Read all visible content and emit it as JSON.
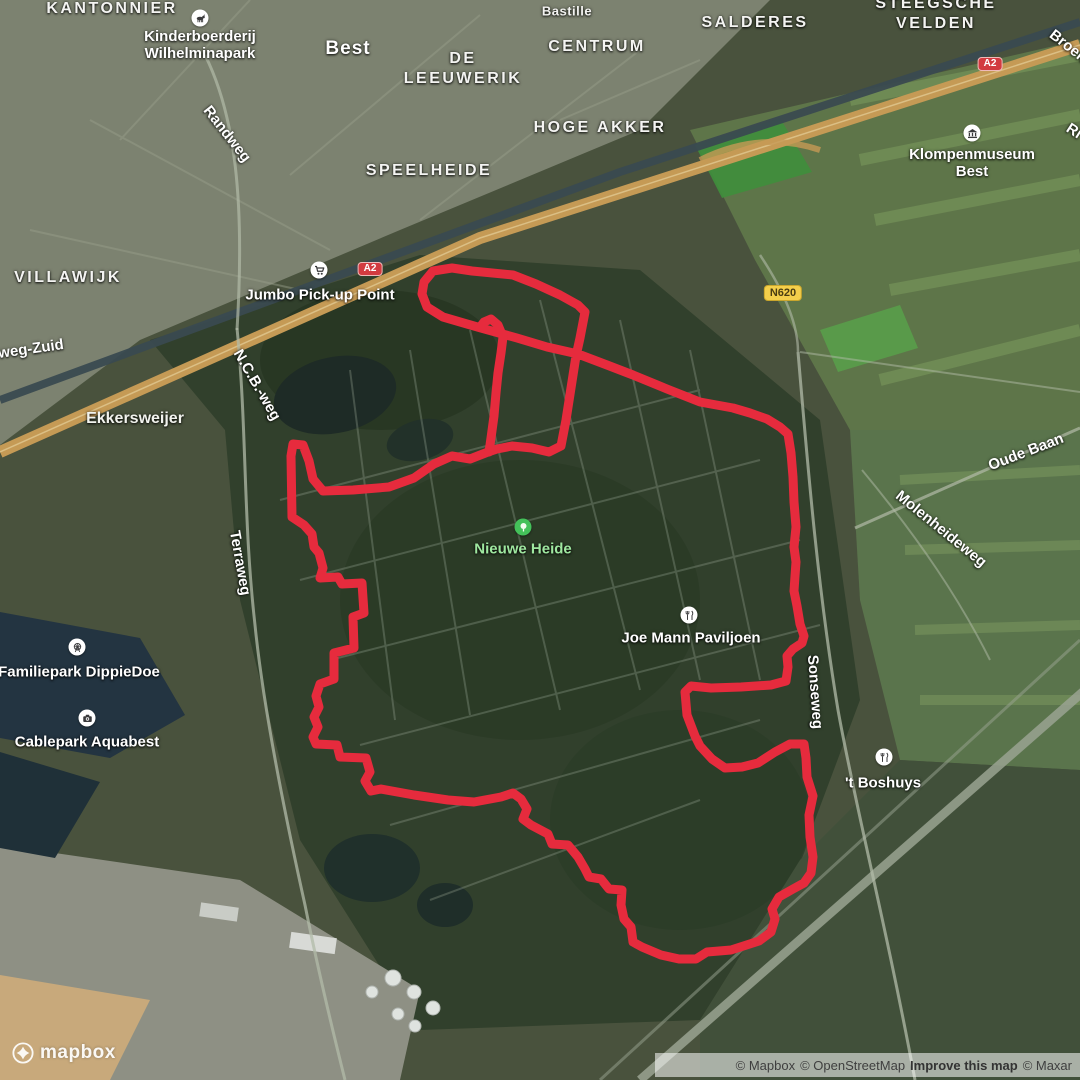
{
  "map": {
    "colors": {
      "route": "#e62b3d",
      "park_text": "#9fe8a0",
      "park_marker": "#44c15a"
    },
    "route": {
      "width": 9,
      "main": [
        [
          481,
          328
        ],
        [
          467,
          324
        ],
        [
          443,
          317
        ],
        [
          427,
          307
        ],
        [
          422,
          294
        ],
        [
          424,
          282
        ],
        [
          433,
          271
        ],
        [
          452,
          268
        ],
        [
          472,
          271
        ],
        [
          513,
          275
        ],
        [
          536,
          284
        ],
        [
          560,
          295
        ],
        [
          578,
          305
        ],
        [
          585,
          312
        ],
        [
          580,
          338
        ],
        [
          576,
          356
        ],
        [
          571,
          388
        ],
        [
          566,
          420
        ],
        [
          561,
          446
        ],
        [
          549,
          452
        ],
        [
          532,
          448
        ],
        [
          512,
          446
        ],
        [
          497,
          449
        ],
        [
          488,
          452
        ],
        [
          470,
          459
        ],
        [
          452,
          456
        ],
        [
          434,
          464
        ],
        [
          414,
          478
        ],
        [
          389,
          487
        ],
        [
          353,
          490
        ],
        [
          323,
          491
        ],
        [
          313,
          479
        ],
        [
          309,
          461
        ],
        [
          303,
          445
        ],
        [
          293,
          444
        ],
        [
          291,
          456
        ],
        [
          292,
          517
        ],
        [
          304,
          525
        ],
        [
          312,
          534
        ],
        [
          314,
          547
        ],
        [
          319,
          553
        ],
        [
          323,
          568
        ],
        [
          320,
          578
        ],
        [
          338,
          577
        ],
        [
          342,
          584
        ],
        [
          362,
          583
        ],
        [
          364,
          613
        ],
        [
          353,
          617
        ],
        [
          354,
          648
        ],
        [
          334,
          653
        ],
        [
          334,
          679
        ],
        [
          320,
          684
        ],
        [
          316,
          696
        ],
        [
          319,
          707
        ],
        [
          314,
          717
        ],
        [
          318,
          727
        ],
        [
          313,
          737
        ],
        [
          316,
          744
        ],
        [
          337,
          745
        ],
        [
          340,
          757
        ],
        [
          366,
          758
        ],
        [
          370,
          772
        ],
        [
          365,
          781
        ],
        [
          371,
          791
        ],
        [
          381,
          789
        ],
        [
          414,
          795
        ],
        [
          448,
          800
        ],
        [
          474,
          802
        ],
        [
          501,
          797
        ],
        [
          513,
          793
        ],
        [
          521,
          799
        ],
        [
          527,
          809
        ],
        [
          523,
          819
        ],
        [
          531,
          825
        ],
        [
          548,
          834
        ],
        [
          552,
          844
        ],
        [
          568,
          845
        ],
        [
          578,
          857
        ],
        [
          585,
          869
        ],
        [
          589,
          877
        ],
        [
          601,
          879
        ],
        [
          609,
          889
        ],
        [
          622,
          890
        ],
        [
          621,
          905
        ],
        [
          624,
          919
        ],
        [
          631,
          927
        ],
        [
          633,
          942
        ],
        [
          642,
          947
        ],
        [
          661,
          955
        ],
        [
          679,
          959
        ],
        [
          696,
          959
        ],
        [
          707,
          952
        ],
        [
          731,
          950
        ],
        [
          759,
          941
        ],
        [
          771,
          932
        ],
        [
          775,
          919
        ],
        [
          772,
          909
        ],
        [
          779,
          897
        ],
        [
          793,
          889
        ],
        [
          804,
          883
        ],
        [
          811,
          873
        ],
        [
          813,
          857
        ],
        [
          810,
          837
        ],
        [
          809,
          815
        ],
        [
          813,
          796
        ],
        [
          807,
          777
        ],
        [
          806,
          758
        ],
        [
          804,
          744
        ],
        [
          790,
          744
        ],
        [
          775,
          752
        ],
        [
          758,
          763
        ],
        [
          742,
          767
        ],
        [
          725,
          768
        ],
        [
          712,
          759
        ],
        [
          700,
          746
        ],
        [
          695,
          736
        ],
        [
          687,
          715
        ],
        [
          685,
          692
        ],
        [
          691,
          686
        ],
        [
          711,
          688
        ],
        [
          741,
          687
        ],
        [
          771,
          685
        ],
        [
          786,
          681
        ],
        [
          788,
          667
        ],
        [
          787,
          656
        ],
        [
          793,
          649
        ],
        [
          802,
          643
        ],
        [
          804,
          636
        ],
        [
          800,
          624
        ],
        [
          797,
          606
        ],
        [
          794,
          591
        ],
        [
          795,
          576
        ],
        [
          796,
          562
        ],
        [
          794,
          547
        ],
        [
          796,
          527
        ],
        [
          794,
          502
        ],
        [
          793,
          477
        ],
        [
          791,
          453
        ],
        [
          788,
          434
        ],
        [
          780,
          427
        ],
        [
          767,
          419
        ],
        [
          750,
          413
        ],
        [
          733,
          408
        ],
        [
          700,
          402
        ],
        [
          667,
          389
        ],
        [
          633,
          375
        ],
        [
          607,
          365
        ],
        [
          578,
          354
        ],
        [
          547,
          347
        ],
        [
          517,
          338
        ],
        [
          481,
          328
        ]
      ],
      "spur": [
        [
          480,
          327
        ],
        [
          484,
          322
        ],
        [
          491,
          319
        ],
        [
          498,
          325
        ],
        [
          503,
          337
        ],
        [
          501,
          353
        ],
        [
          498,
          373
        ],
        [
          496,
          393
        ],
        [
          494,
          416
        ],
        [
          491,
          438
        ],
        [
          489,
          452
        ]
      ]
    },
    "shields": [
      {
        "id": "a2-shield-west",
        "label": "A2",
        "x": 370,
        "y": 269,
        "type": "motorway"
      },
      {
        "id": "a2-shield-east",
        "label": "A2",
        "x": 990,
        "y": 64,
        "type": "motorway"
      },
      {
        "id": "n620-shield",
        "label": "N620",
        "x": 783,
        "y": 293,
        "type": "provincial"
      }
    ],
    "area_labels": [
      {
        "id": "kantonnier",
        "lines": [
          "KANTONNIER"
        ],
        "x": 112,
        "y": 9,
        "cls": "lbl-area"
      },
      {
        "id": "best",
        "lines": [
          "Best"
        ],
        "x": 348,
        "y": 49,
        "cls": "lbl-city"
      },
      {
        "id": "bastille",
        "lines": [
          "Bastille"
        ],
        "x": 567,
        "y": 11,
        "cls": "lbl-suburb"
      },
      {
        "id": "centrum",
        "lines": [
          "CENTRUM"
        ],
        "x": 597,
        "y": 47,
        "cls": "lbl-area"
      },
      {
        "id": "de-leeuwerik",
        "lines": [
          "DE",
          "LEEUWERIK"
        ],
        "x": 463,
        "y": 69,
        "cls": "lbl-area"
      },
      {
        "id": "salderes",
        "lines": [
          "SALDERES"
        ],
        "x": 755,
        "y": 23,
        "cls": "lbl-area"
      },
      {
        "id": "steegsche-velden",
        "lines": [
          "STEEGSCHE",
          "VELDEN"
        ],
        "x": 936,
        "y": 14,
        "cls": "lbl-area"
      },
      {
        "id": "hoge-akker",
        "lines": [
          "HOGE AKKER"
        ],
        "x": 600,
        "y": 128,
        "cls": "lbl-area"
      },
      {
        "id": "speelheide",
        "lines": [
          "SPEELHEIDE"
        ],
        "x": 429,
        "y": 171,
        "cls": "lbl-area"
      },
      {
        "id": "villawijk",
        "lines": [
          "VILLAWIJK"
        ],
        "x": 68,
        "y": 278,
        "cls": "lbl-area"
      },
      {
        "id": "ekkersweijer",
        "lines": [
          "Ekkersweijer"
        ],
        "x": 135,
        "y": 419,
        "cls": "lbl-lake"
      }
    ],
    "road_labels": [
      {
        "id": "randweg",
        "text": "Randweg",
        "x": 227,
        "y": 134,
        "rot": 52
      },
      {
        "id": "weg-zuid",
        "text": "weg-Zuid",
        "x": 31,
        "y": 349,
        "rot": -8
      },
      {
        "id": "ncb-weg",
        "text": "N.C.B.-weg",
        "x": 257,
        "y": 385,
        "rot": 60
      },
      {
        "id": "terraweg",
        "text": "Terraweg",
        "x": 240,
        "y": 563,
        "rot": 80
      },
      {
        "id": "oude-baan",
        "text": "Oude Baan",
        "x": 1026,
        "y": 452,
        "rot": -21
      },
      {
        "id": "molenheideweg",
        "text": "Molenheideweg",
        "x": 941,
        "y": 529,
        "rot": 39
      },
      {
        "id": "sonseweg",
        "text": "Sonseweg",
        "x": 815,
        "y": 692,
        "rot": 86
      },
      {
        "id": "broek",
        "text": "Broek",
        "x": 1068,
        "y": 46,
        "rot": 38
      },
      {
        "id": "ri",
        "text": "Ri",
        "x": 1074,
        "y": 131,
        "rot": 33
      }
    ],
    "pois": [
      {
        "id": "kinderboerderij-wilhelminapark",
        "icon": "animal-icon",
        "x": 200,
        "y": 18,
        "tx": 200,
        "ty": 45,
        "lines": [
          "Kinderboerderij",
          "Wilhelminapark"
        ]
      },
      {
        "id": "jumbo-pickup-point",
        "icon": "cart-icon",
        "x": 319,
        "y": 270,
        "tx": 320,
        "ty": 295,
        "lines": [
          "Jumbo Pick-up Point"
        ]
      },
      {
        "id": "klompenmuseum-best",
        "icon": "museum-icon",
        "x": 972,
        "y": 133,
        "tx": 972,
        "ty": 163,
        "lines": [
          "Klompenmuseum",
          "Best"
        ]
      },
      {
        "id": "nieuwe-heide",
        "icon": "tree-icon",
        "x": 523,
        "y": 527,
        "tx": 523,
        "ty": 549,
        "lines": [
          "Nieuwe Heide"
        ],
        "park": true
      },
      {
        "id": "joe-mann-paviljoen",
        "icon": "restaurant-icon",
        "x": 689,
        "y": 615,
        "tx": 691,
        "ty": 638,
        "lines": [
          "Joe Mann Paviljoen"
        ]
      },
      {
        "id": "familiepark-dippiedoe",
        "icon": "ferris-wheel-icon",
        "x": 77,
        "y": 647,
        "tx": 79,
        "ty": 672,
        "lines": [
          "Familiepark DippieDoe"
        ]
      },
      {
        "id": "cablepark-aquabest",
        "icon": "camera-icon",
        "x": 87,
        "y": 718,
        "tx": 87,
        "ty": 742,
        "lines": [
          "Cablepark Aquabest"
        ]
      },
      {
        "id": "t-boshuys",
        "icon": "restaurant-icon",
        "x": 884,
        "y": 757,
        "tx": 883,
        "ty": 783,
        "lines": [
          "'t Boshuys"
        ]
      }
    ]
  },
  "logo": {
    "text": "mapbox"
  },
  "attribution": {
    "mapbox": "© Mapbox",
    "osm": "© OpenStreetMap",
    "improve": "Improve this map",
    "maxar": "© Maxar"
  }
}
